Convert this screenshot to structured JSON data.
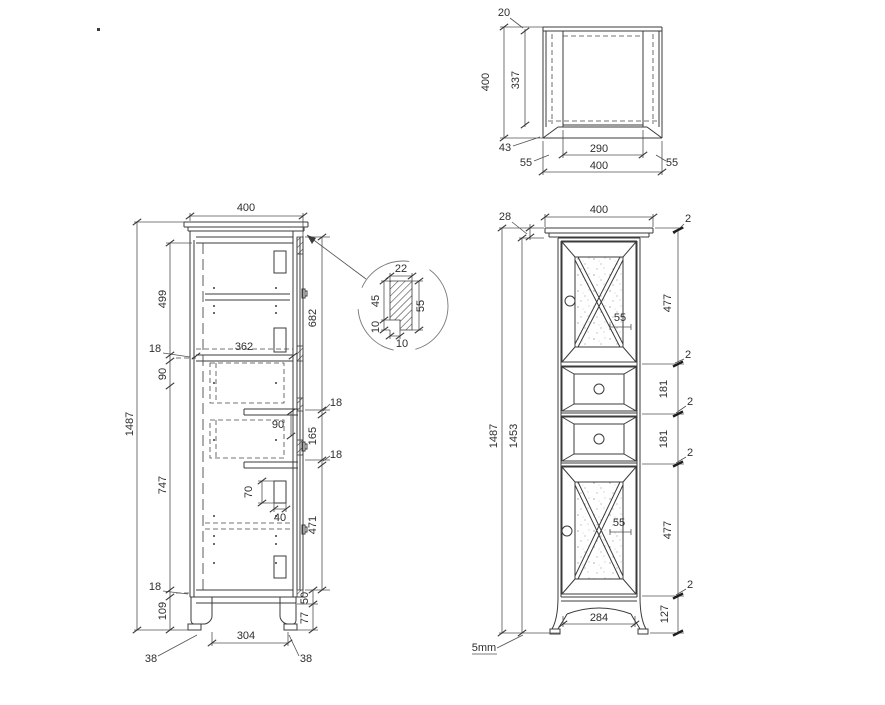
{
  "drawing": {
    "side_view": {
      "depth_top": "400",
      "height_total": "1487",
      "upper_interior_height": "499",
      "shelf_thickness": "18",
      "rail_height": "90",
      "lower_interior_height": "747",
      "plinth_height": "109",
      "interior_depth": "362",
      "top_door_height": "682",
      "drawer_overlay": "90",
      "drawer_front_height": "165",
      "gap_upper": "18",
      "gap_lower": "18",
      "hinge_offset": "70",
      "hinge_width": "40",
      "bottom_door_height": "471",
      "bottom_panel_thickness": "18",
      "apron_height": "50",
      "leg_height": "77",
      "leg_spacing": "304",
      "back_leg_width": "38",
      "front_leg_width": "38"
    },
    "detail_view": {
      "profile_width": "22",
      "upper_height": "45",
      "total_height": "55",
      "notch_height": "10",
      "notch_width": "10"
    },
    "top_view": {
      "back_thickness": "20",
      "depth_total": "400",
      "interior_depth": "337",
      "front_rail": "43",
      "side_left": "55",
      "interior_width": "290",
      "width_total": "400",
      "side_right": "55"
    },
    "front_view": {
      "cornice_height": "28",
      "width_total": "400",
      "gap_top": "2",
      "top_door_height": "477",
      "muntin_top": "55",
      "gap_upper": "2",
      "height_total": "1487",
      "height_body": "1453",
      "drawer_one_height": "181",
      "gap_mid_one": "2",
      "drawer_two_height": "181",
      "gap_mid_two": "2",
      "bottom_door_height": "477",
      "muntin_bottom": "55",
      "gap_bottom": "2",
      "base_height": "127",
      "base_width": "284",
      "clearance_note": "5mm"
    }
  }
}
